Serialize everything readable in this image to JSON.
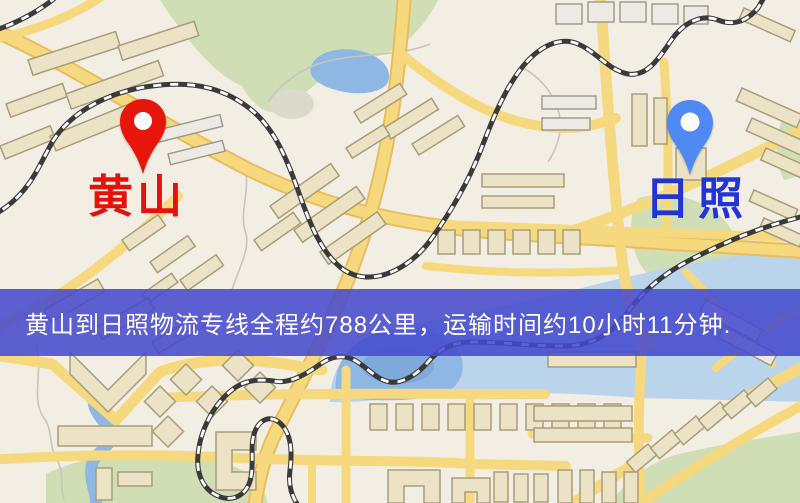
{
  "banner": {
    "text": "黄山到日照物流专线全程约788公里，运输时间约10小时11分钟.",
    "background_color": "#454acc",
    "text_color": "#ffffff",
    "distance_km": "788",
    "duration": "10小时11分钟"
  },
  "markers": {
    "origin": {
      "label": "黄山",
      "pin_color": "#e8150b",
      "label_color": "#e8100a"
    },
    "destination": {
      "label": "日照",
      "pin_color": "#4e89f4",
      "label_color": "#2334d6"
    }
  },
  "map_colors": {
    "background": "#f2eee4",
    "road": "#f6d97f",
    "road_casing": "#e8bd5e",
    "water": "#8fb7e4",
    "water_light": "#bad4ec",
    "park": "#cfdeb5",
    "building": "#ece3c6",
    "building_outline": "#a79d78",
    "railway": "#3a3a3a"
  }
}
